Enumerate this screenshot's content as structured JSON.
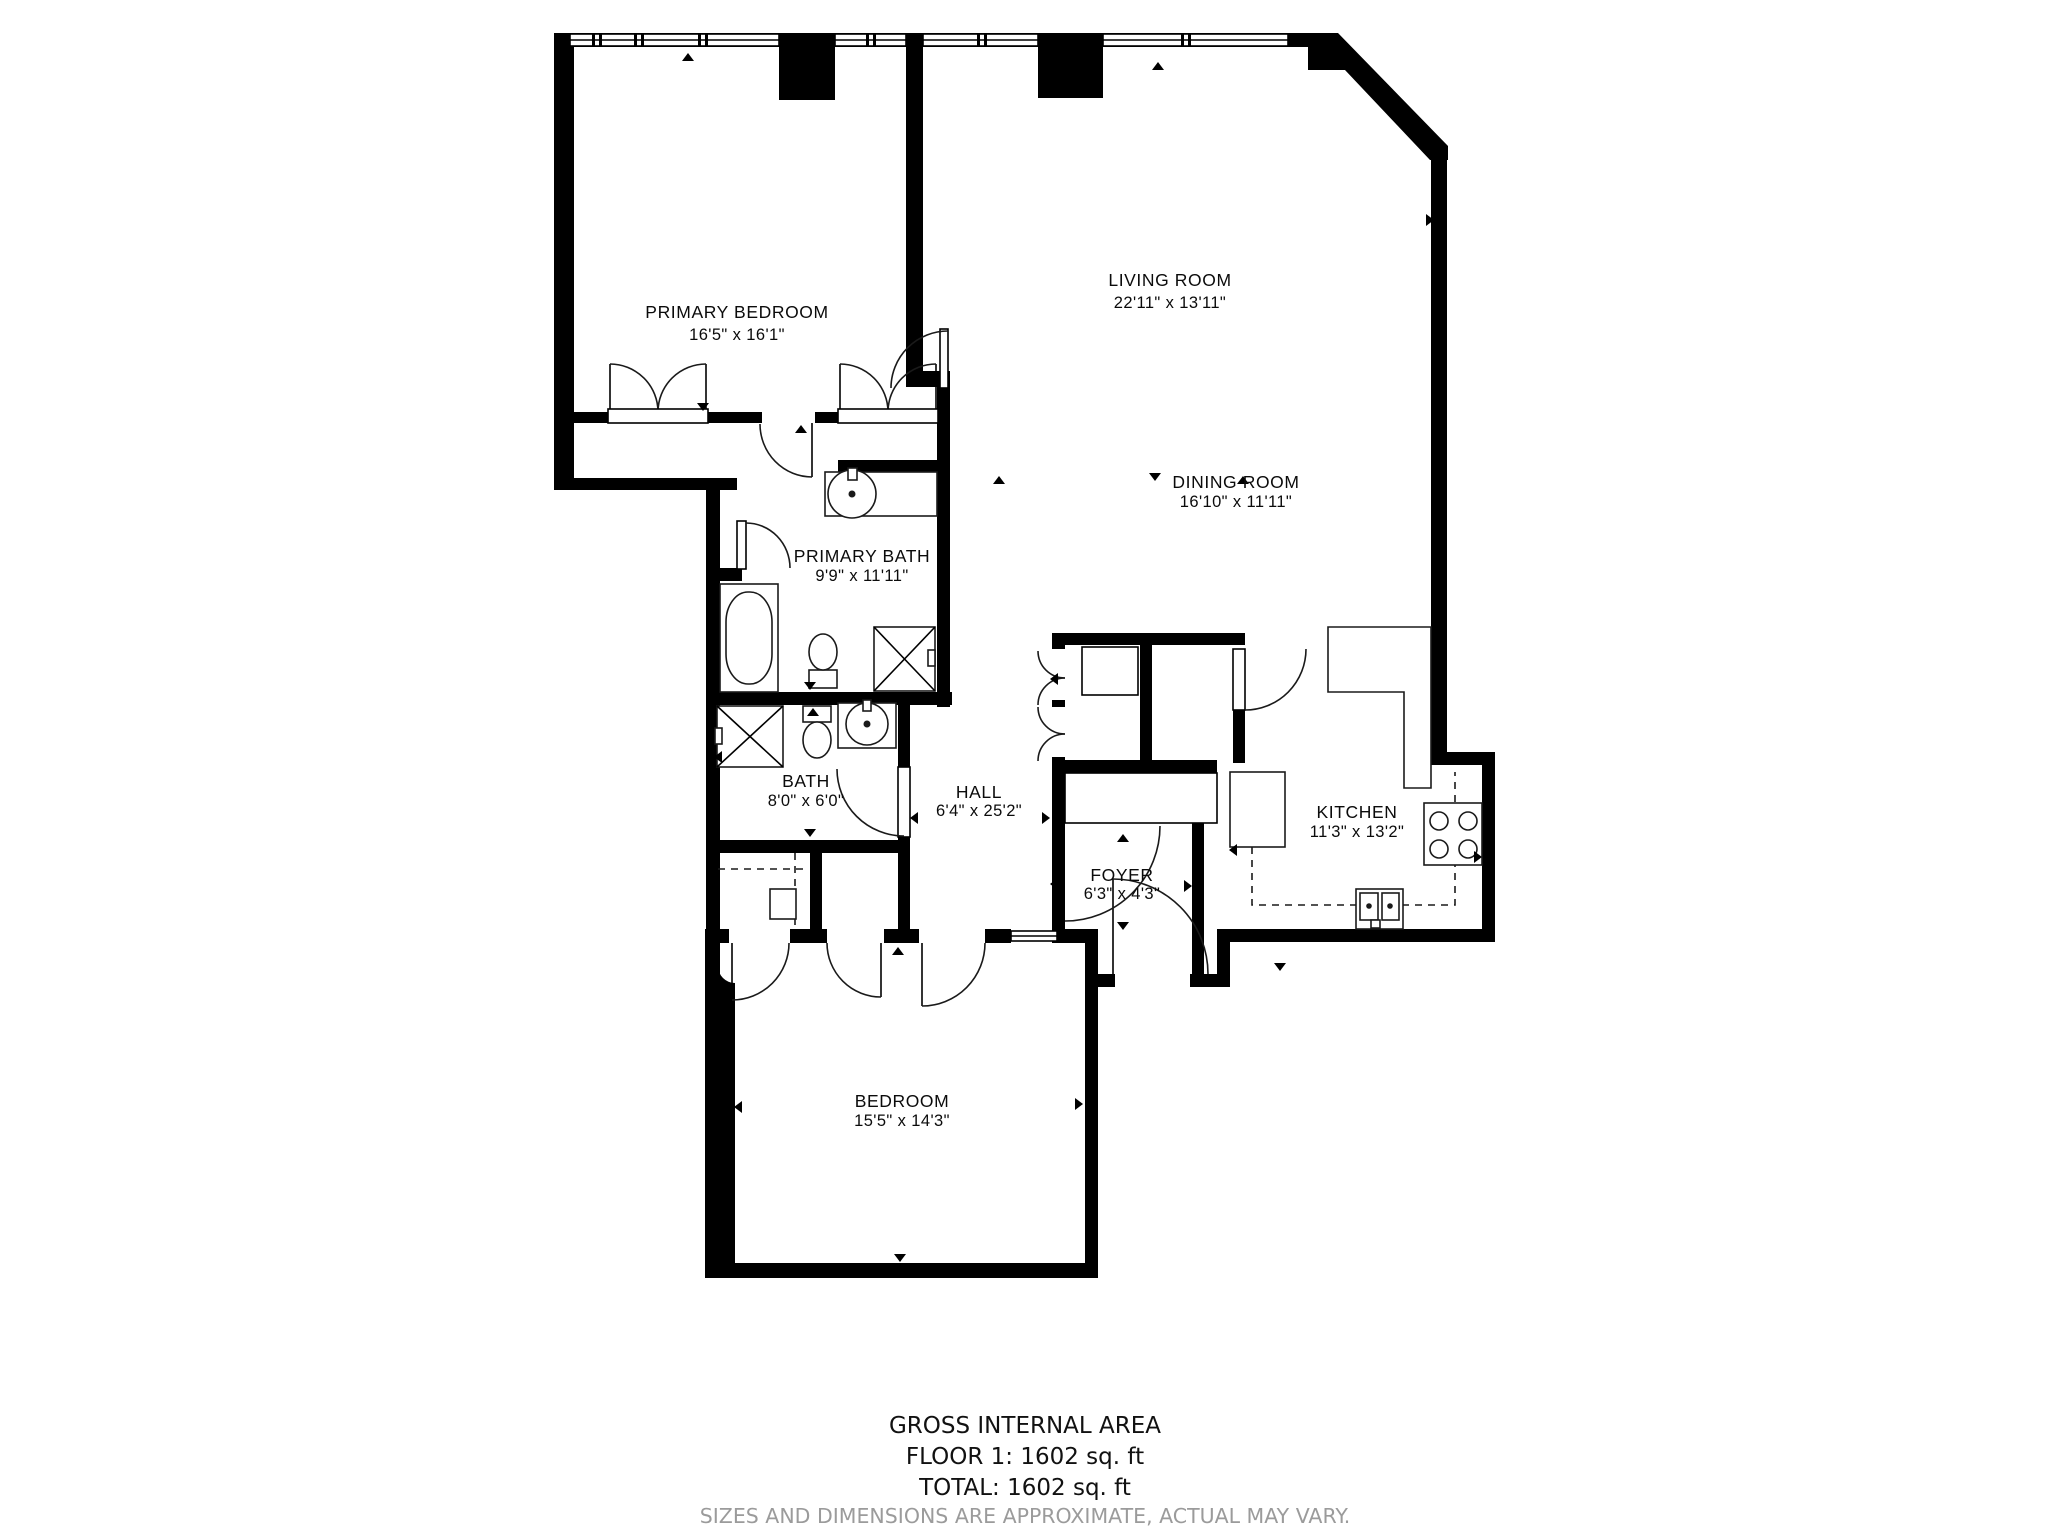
{
  "plan": {
    "rooms": {
      "primary_bedroom": {
        "name": "PRIMARY BEDROOM",
        "dims": "16'5\" x 16'1\""
      },
      "living_room": {
        "name": "LIVING ROOM",
        "dims": "22'11\" x 13'11\""
      },
      "dining_room": {
        "name": "DINING ROOM",
        "dims": "16'10\" x 11'11\""
      },
      "primary_bath": {
        "name": "PRIMARY BATH",
        "dims": "9'9\" x 11'11\""
      },
      "bath": {
        "name": "BATH",
        "dims": "8'0\" x 6'0\""
      },
      "hall": {
        "name": "HALL",
        "dims": "6'4\" x 25'2\""
      },
      "foyer": {
        "name": "FOYER",
        "dims": "6'3\" x 4'3\""
      },
      "kitchen": {
        "name": "KITCHEN",
        "dims": "11'3\" x 13'2\""
      },
      "bedroom": {
        "name": "BEDROOM",
        "dims": "15'5\" x 14'3\""
      }
    },
    "footer": {
      "area_title": "GROSS INTERNAL AREA",
      "floor_line": "FLOOR 1: 1602 sq. ft",
      "total_line": "TOTAL: 1602 sq. ft",
      "disclaimer": "SIZES AND DIMENSIONS ARE APPROXIMATE, ACTUAL MAY VARY."
    },
    "colors": {
      "wall": "#000000",
      "floor": "#ffffff",
      "disclaimer_gray": "#9b9b9b"
    }
  }
}
